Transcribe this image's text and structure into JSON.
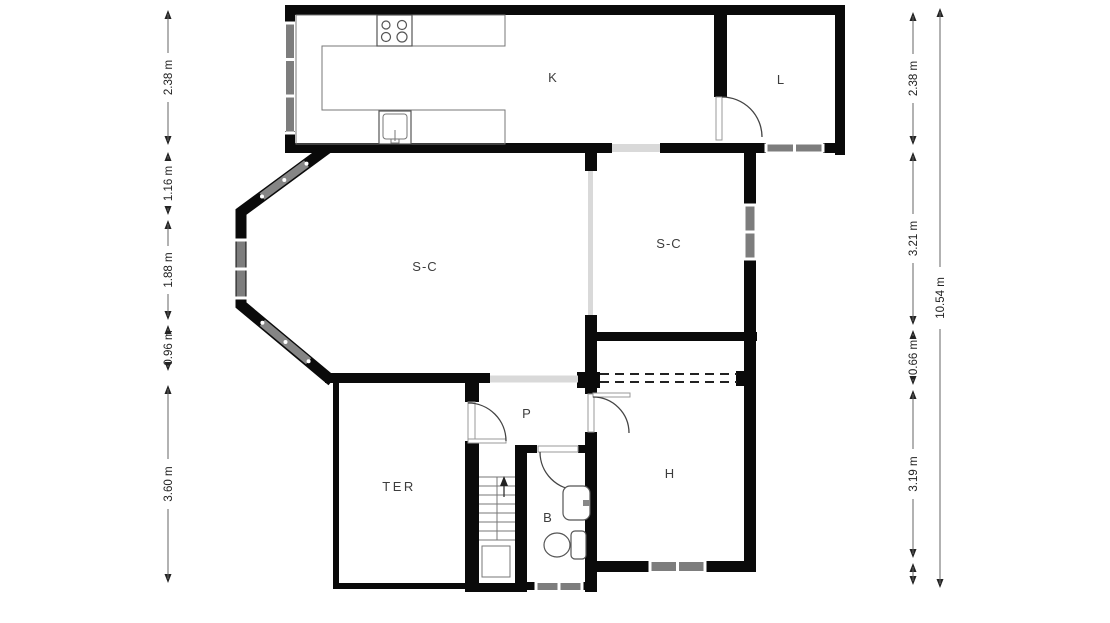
{
  "plan": {
    "title": "floor-plan",
    "rooms": [
      {
        "id": "kitchen",
        "label": "K"
      },
      {
        "id": "laundry",
        "label": "L"
      },
      {
        "id": "living-left",
        "label": "S-C"
      },
      {
        "id": "living-right",
        "label": "S-C"
      },
      {
        "id": "hall",
        "label": "P"
      },
      {
        "id": "terrace",
        "label": "TER"
      },
      {
        "id": "bathroom",
        "label": "B"
      },
      {
        "id": "bedroom",
        "label": "H"
      }
    ],
    "dimensions": {
      "left": [
        "2.38 m",
        "1.16 m",
        "1.88 m",
        "0.96 m",
        "3.60 m"
      ],
      "right": [
        "2.38 m",
        "3.21 m",
        "0.66 m",
        "3.19 m"
      ],
      "overall": "10.54 m"
    },
    "colors": {
      "wall": "#0a0a0a",
      "window": "#7d7d7d",
      "opening": "#d9d9d9",
      "background": "#ffffff"
    }
  }
}
